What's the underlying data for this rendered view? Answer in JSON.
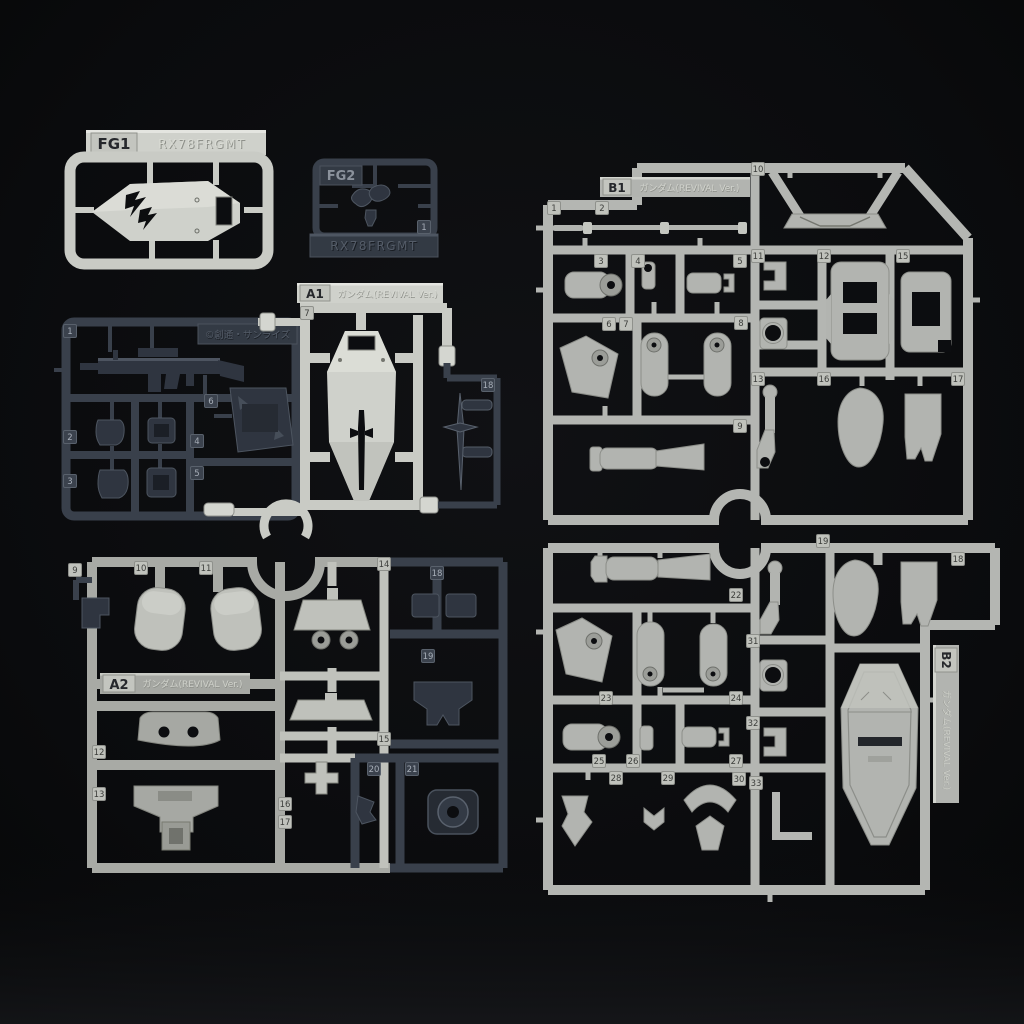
{
  "kit": {
    "product_code": "RX78FRGMT"
  },
  "runners": {
    "fg1": {
      "code": "FG1",
      "model": "RX78FRGMT"
    },
    "fg2": {
      "code": "FG2",
      "model": "RX78FRGMT"
    },
    "a1": {
      "code": "A1",
      "name": "ガンダム(REVIVAL Ver.)"
    },
    "a2": {
      "code": "A2",
      "name": "ガンダム(REVIVAL Ver.)"
    },
    "b1": {
      "code": "B1",
      "name": "ガンダム(REVIVAL Ver.)"
    },
    "b2": {
      "code": "B2",
      "name": "ガンダム(REVIVAL Ver.)"
    }
  },
  "copyright": "©創通・サンライズ",
  "colors": {
    "background": "#0b0c0e",
    "light_plastic": "#c9cbc5",
    "gray_plastic": "#b4b6b2",
    "mid_plastic": "#a6a8a3",
    "dark_plastic": "#323945"
  },
  "part_tags": {
    "a_dark": [
      [
        1,
        70,
        331
      ],
      [
        2,
        70,
        437
      ],
      [
        3,
        70,
        481
      ],
      [
        4,
        197,
        441
      ],
      [
        5,
        197,
        473
      ],
      [
        6,
        211,
        401
      ]
    ],
    "fg2": [
      [
        1,
        424,
        227
      ]
    ],
    "a1_light": [
      [
        7,
        307,
        313
      ]
    ],
    "a1_dark": [
      [
        18,
        488,
        385
      ]
    ],
    "a2_light": [
      [
        9,
        75,
        570
      ],
      [
        10,
        141,
        568
      ],
      [
        11,
        206,
        568
      ],
      [
        12,
        99,
        752
      ],
      [
        13,
        99,
        794
      ],
      [
        14,
        384,
        564
      ],
      [
        15,
        384,
        739
      ],
      [
        16,
        285,
        804
      ],
      [
        17,
        285,
        822
      ]
    ],
    "a2_dark": [
      [
        18,
        437,
        573
      ],
      [
        19,
        428,
        656
      ],
      [
        20,
        374,
        769
      ],
      [
        21,
        412,
        769
      ]
    ],
    "b1": [
      [
        1,
        554,
        208
      ],
      [
        2,
        602,
        208
      ],
      [
        3,
        601,
        261
      ],
      [
        4,
        638,
        261
      ],
      [
        5,
        740,
        261
      ],
      [
        6,
        609,
        324
      ],
      [
        7,
        626,
        324
      ],
      [
        8,
        741,
        323
      ],
      [
        9,
        740,
        426
      ],
      [
        10,
        758,
        169
      ],
      [
        11,
        758,
        256
      ],
      [
        12,
        824,
        256
      ],
      [
        13,
        758,
        379
      ],
      [
        15,
        903,
        256
      ],
      [
        16,
        824,
        379
      ],
      [
        17,
        958,
        379
      ]
    ],
    "b2": [
      [
        19,
        823,
        541
      ],
      [
        18,
        958,
        559
      ],
      [
        22,
        736,
        595
      ],
      [
        23,
        606,
        698
      ],
      [
        24,
        736,
        698
      ],
      [
        25,
        599,
        761
      ],
      [
        26,
        633,
        761
      ],
      [
        27,
        736,
        761
      ],
      [
        28,
        616,
        778
      ],
      [
        29,
        668,
        778
      ],
      [
        30,
        739,
        779
      ],
      [
        31,
        753,
        641
      ],
      [
        32,
        753,
        723
      ],
      [
        33,
        756,
        783
      ]
    ]
  }
}
